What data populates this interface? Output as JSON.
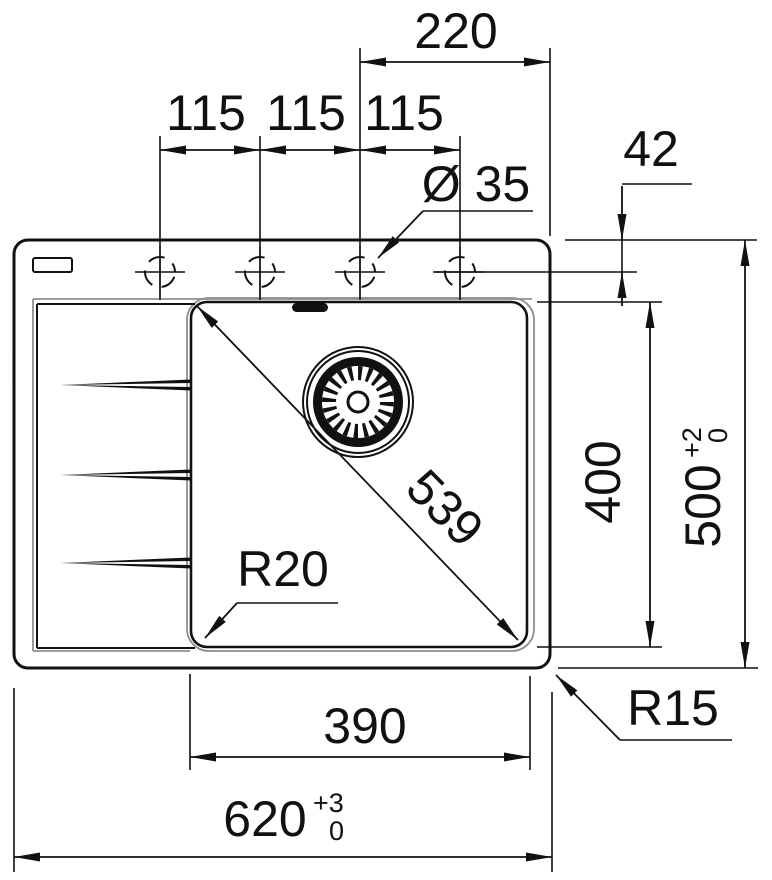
{
  "diagram": {
    "title": "sink-cutout-dimension-drawing",
    "units_note": "technical drawing, dimension values as printed",
    "colors": {
      "line": "#111111",
      "secondary": "#8f8f8f",
      "background": "#ffffff"
    },
    "dims": {
      "top_span": "220",
      "hole_pitch_1": "115",
      "hole_pitch_2": "115",
      "hole_pitch_3": "115",
      "hole_diameter": "Ø 35",
      "hole_offset": "42",
      "bowl_depth": "400",
      "overall_depth": "500",
      "overall_depth_tol_plus": "+2",
      "overall_depth_tol_minus": "0",
      "bowl_diagonal": "539",
      "bowl_corner_radius": "R20",
      "bowl_width": "390",
      "overall_width": "620",
      "overall_width_tol_plus": "+3",
      "overall_width_tol_minus": "0",
      "outer_corner_radius": "R15"
    }
  }
}
